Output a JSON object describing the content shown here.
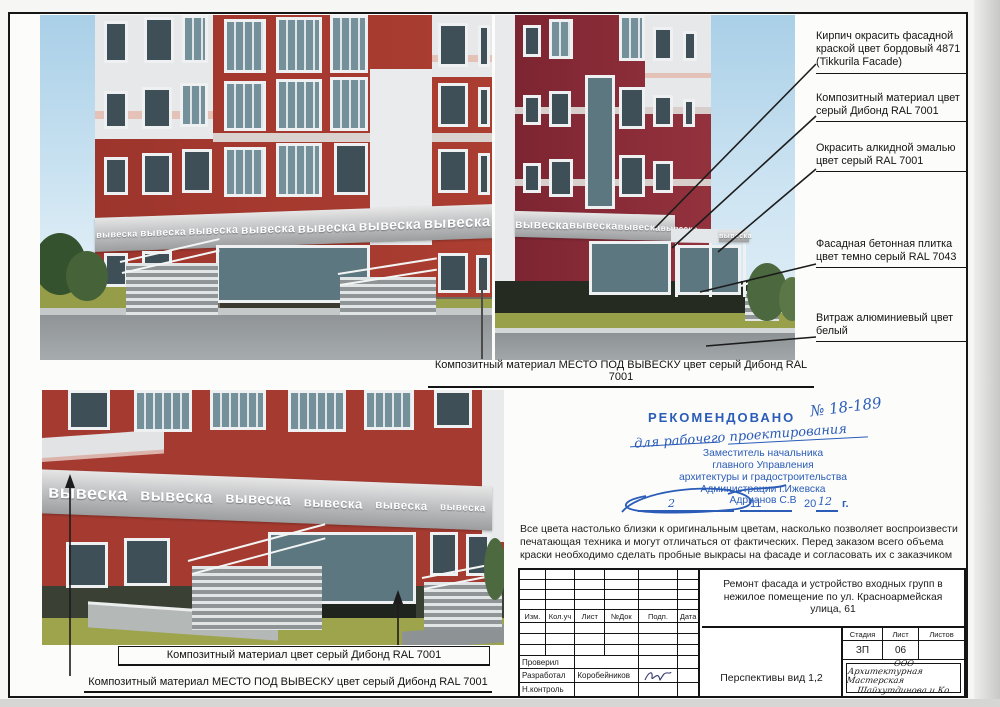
{
  "doc": {
    "sign_text": "вывеска",
    "annotations": [
      "Кирпич окрасить фасадной краской цвет бордовый 4871 (Tikkurila Facade)",
      "Композитный материал цвет серый Дибонд RAL 7001",
      "Окрасить алкидной эмалью цвет серый RAL 7001",
      "Фасадная бетонная плитка цвет темно серый RAL 7043",
      "Витраж алюминиевый цвет белый"
    ],
    "captions": {
      "top": "Композитный материал МЕСТО ПОД ВЫВЕСКУ цвет серый Дибонд RAL 7001",
      "bottom_box": "Композитный материал цвет серый Дибонд RAL 7001",
      "bottom_underline": "Композитный материал МЕСТО ПОД ВЫВЕСКУ цвет серый Дибонд RAL 7001"
    },
    "note": "Все цвета настолько близки к оригинальным цветам, насколько позволяет воспроизвести печатающая техника и могут отличаться от фактических. Перед заказом всего объема краски необходимо сделать пробные выкрасы на фасаде и согласовать их с заказчиком",
    "stamp": {
      "title": "РЕКОМЕНДОВАНО",
      "number": "№ 18-189",
      "handnote": "для рабочего проектирования",
      "line1": "Заместитель начальника",
      "line2": "главного Управления",
      "line3": "архитектуры и градостроительства",
      "line4": "Администрации г.Ижевска",
      "line5": "Адрианов С.В",
      "date_day": "2",
      "date_month": "11",
      "date_century": "20",
      "date_year": "12",
      "date_suffix": "г."
    },
    "title_block": {
      "col_izm": "Изм.",
      "col_koluch": "Кол.уч",
      "col_list": "Лист",
      "col_ndok": "№Док",
      "col_podp": "Подп.",
      "col_data": "Дата",
      "project": "Ремонт фасада и устройство входных групп в нежилое помещение по ул. Красноармейская улица, 61",
      "stage_label": "Стадия",
      "list_label": "Лист",
      "listov_label": "Листов",
      "stage": "ЗП",
      "list_num": "06",
      "listov": "",
      "row1_role": "Проверил",
      "row2_role": "Разработал",
      "row2_name": "Коробейников",
      "row3_role": "Н.контроль",
      "view_title": "Перспективы вид 1,2",
      "company_line1": "ООО",
      "company_line2": "Архитектурная Мастерская",
      "company_line3": "Шайхутдинова и Ко"
    },
    "colors": {
      "brick_red": "#a5392f",
      "bordeaux": "#8a2c38",
      "sign_band_gray": "#b9babc",
      "stamp_blue": "#2a5cb8"
    }
  }
}
